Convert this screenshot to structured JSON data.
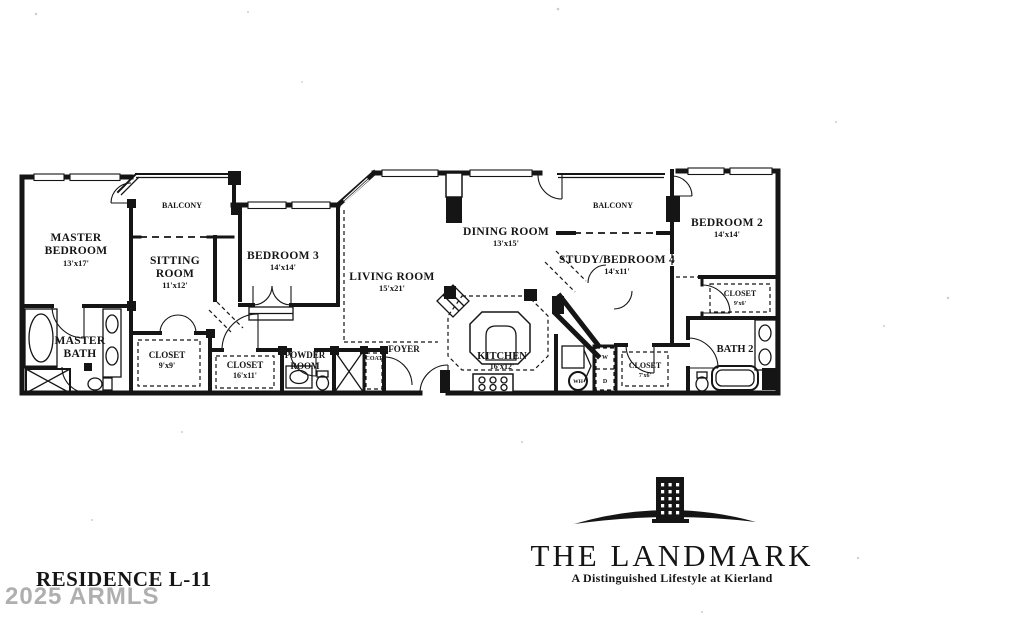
{
  "document": {
    "type": "scanned-floor-plan"
  },
  "colors": {
    "ink": "#151515",
    "paper": "#ffffff",
    "watermark_gray": "#9c9c9c"
  },
  "rooms": {
    "master_bedroom": {
      "line1": "MASTER",
      "line2": "BEDROOM",
      "dims": "13'x17'"
    },
    "balcony_left": {
      "label": "BALCONY"
    },
    "sitting_room": {
      "line1": "SITTING",
      "line2": "ROOM",
      "dims": "11'x12'"
    },
    "bedroom_3": {
      "label": "BEDROOM 3",
      "dims": "14'x14'"
    },
    "living_room": {
      "label": "LIVING ROOM",
      "dims": "15'x21'"
    },
    "dining_room": {
      "label": "DINING ROOM",
      "dims": "13'x15'"
    },
    "balcony_right": {
      "label": "BALCONY"
    },
    "study_bedroom_4": {
      "label": "STUDY/BEDROOM 4",
      "dims": "14'x11'"
    },
    "bedroom_2": {
      "label": "BEDROOM 2",
      "dims": "14'x14'"
    },
    "master_bath": {
      "line1": "MASTER",
      "line2": "BATH"
    },
    "closet_master": {
      "label": "CLOSET",
      "dims": "9'x9'"
    },
    "closet_hall": {
      "label": "CLOSET",
      "dims": "16'x11'"
    },
    "powder_room": {
      "line1": "POWDER",
      "line2": "ROOM"
    },
    "coat_closet": {
      "label": "COAT"
    },
    "foyer": {
      "label": "FOYER"
    },
    "kitchen": {
      "label": "KITCHEN",
      "dims": "16'x12'"
    },
    "water_heater": {
      "label": "WH"
    },
    "washer": {
      "label": "W"
    },
    "dryer": {
      "label": "D"
    },
    "closet_laundry": {
      "label": "CLOSET",
      "dims": "7'x6'"
    },
    "closet_bedroom_2": {
      "label": "CLOSET",
      "dims": "9'x6'"
    },
    "bath_2": {
      "label": "BATH 2"
    }
  },
  "title": {
    "residence": "RESIDENCE L-11"
  },
  "watermark": {
    "text": "2025 ARMLS"
  },
  "brand": {
    "name": "THE LANDMARK",
    "tagline": "A Distinguished Lifestyle at Kierland"
  }
}
